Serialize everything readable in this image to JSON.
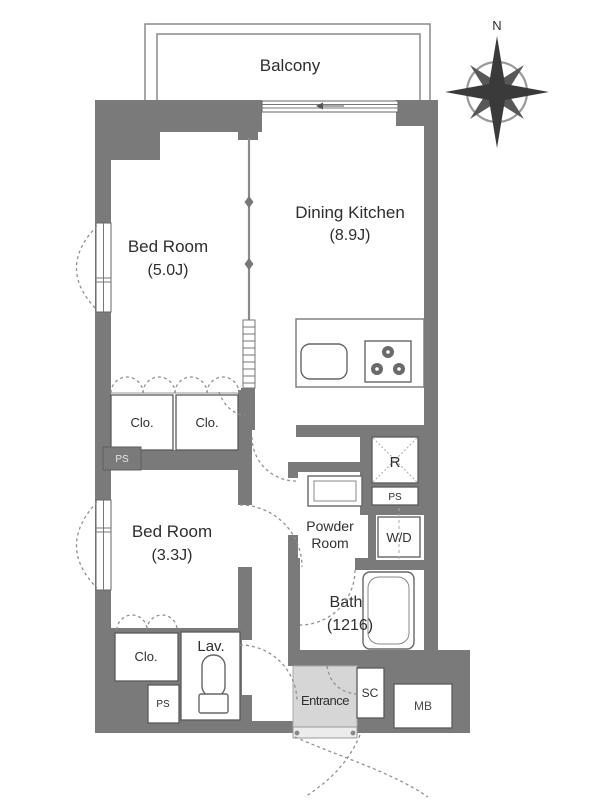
{
  "plan": {
    "balcony": "Balcony",
    "compass_north": "N",
    "rooms": {
      "dining_kitchen": {
        "name": "Dining Kitchen",
        "size": "(8.9J)"
      },
      "bedroom_1": {
        "name": "Bed Room",
        "size": "(5.0J)"
      },
      "bedroom_2": {
        "name": "Bed Room",
        "size": "(3.3J)"
      },
      "bath": {
        "name": "Bath",
        "size": "(1216)"
      },
      "powder_room": {
        "line1": "Powder",
        "line2": "Room"
      },
      "lavatory": "Lav.",
      "entrance": "Entrance"
    },
    "storage": {
      "closet_1": "Clo.",
      "closet_2": "Clo.",
      "closet_3": "Clo.",
      "shoe_closet": "SC",
      "meter_box": "MB",
      "washer_dryer": "W/D",
      "refrigerator": "R",
      "pipe_space_left": "PS",
      "pipe_space_right": "PS",
      "pipe_space_bottom": "PS"
    },
    "colors": {
      "wall": "#7a7a7a",
      "line": "#5a5a5a",
      "entrance_floor": "#d6d6d6"
    }
  }
}
